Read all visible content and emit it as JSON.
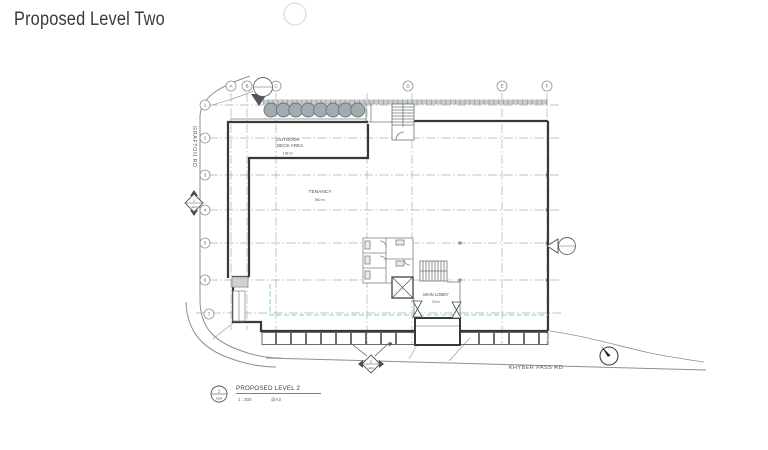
{
  "page": {
    "title": "Proposed Level Two"
  },
  "drawing": {
    "streets": {
      "left": "GRAFTON RD",
      "bottom": "KHYBER PASS RD"
    },
    "rooms": {
      "outdoor_deck": {
        "line1": "OUTDOOR",
        "line2": "DECK AREA",
        "area": "138 m²"
      },
      "tenancy": {
        "name": "TENANCY",
        "area": "960 m²"
      },
      "main_lobby": {
        "name": "MAIN LOBBY",
        "area": "26 m²"
      }
    },
    "grid": {
      "columns": [
        "A",
        "B",
        "C",
        "D",
        "E",
        "F",
        "G"
      ],
      "rows": [
        "1",
        "2",
        "3",
        "4",
        "5",
        "6",
        "7"
      ]
    },
    "markers": {
      "section_left": {
        "number": "1",
        "sheet": "A201"
      },
      "detail_bottom": {
        "number": "2",
        "sheet": "A201"
      }
    },
    "titleblock": {
      "number": "1",
      "sheet": "A204",
      "title": "PROPOSED LEVEL 2",
      "scale": "1 : 200",
      "paper": "@A3"
    },
    "colors": {
      "wall": "#383838",
      "grid": "#a9aeb3",
      "tree": "#a2abb0",
      "outline_below": "#7fcddb"
    }
  }
}
